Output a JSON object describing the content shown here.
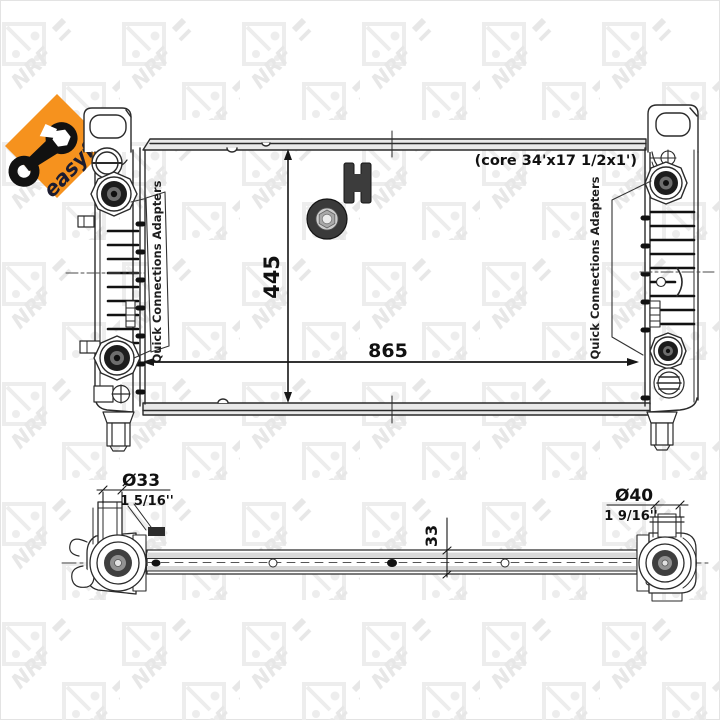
{
  "page": {
    "background_color": "#ffffff",
    "line_color": "#2a2a2a"
  },
  "badge": {
    "label": "easyfit",
    "diamond_color": "#f6921e",
    "label_color": "#1c1c30"
  },
  "watermark": {
    "letters": "NRF",
    "color": "#e9e9e9"
  },
  "front_view": {
    "core_note": "(core 34'x17 1/2x1')",
    "height_dim": "445",
    "width_dim": "865",
    "left_callout_label": "Quick Connections Adapters",
    "right_callout_label": "Quick Connections Adapters"
  },
  "bottom_view": {
    "left_port_diameter": "Ø33",
    "left_port_inches": "1 5/16''",
    "right_port_diameter": "Ø40",
    "right_port_inches": "1 9/16''",
    "core_thickness_dim": "33"
  }
}
